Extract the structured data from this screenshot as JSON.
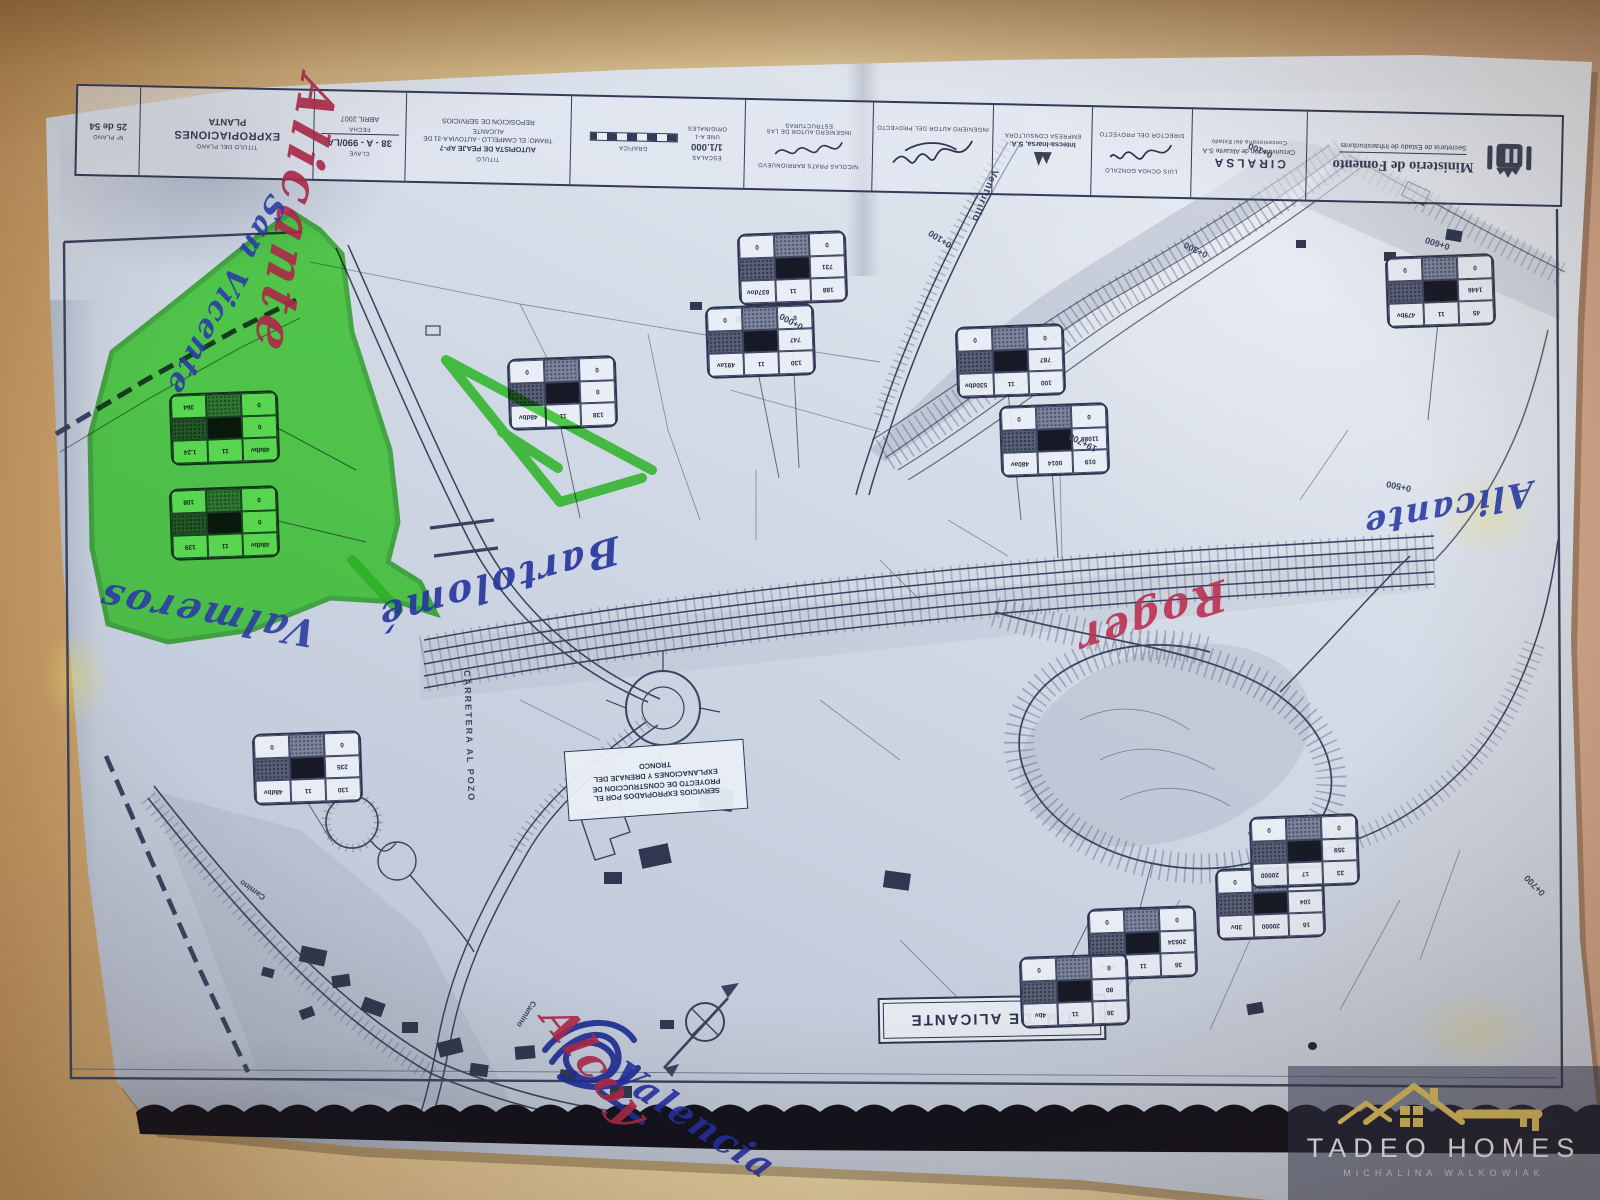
{
  "title_block": {
    "sheet_no": {
      "label": "Nº PLANO",
      "value": "25 de 54"
    },
    "plan_title": {
      "label": "TITULO DEL PLANO",
      "line1": "EXPROPIACIONES",
      "line2": "PLANTA"
    },
    "code": {
      "label": "CLAVE",
      "value": "38 - A - 990/LA",
      "date_label": "FECHA",
      "date": "ABRIL 2007"
    },
    "project": {
      "label": "TITULO",
      "line1": "AUTOPISTA DE PEAJE AP-7",
      "line2": "TRAMO: EL CAMPELLO - AUTOVIA A-31 DE ALICANTE",
      "line3": "REPOSICION DE SERVICIOS"
    },
    "scales": {
      "label": "ESCALAS",
      "value": "1/1.000",
      "note1": "UNE A-1",
      "note2": "ORIGINALES",
      "graphic_label": "GRAFICA"
    },
    "structures": {
      "name": "NICOLAS PRATS BARRIONUEVO",
      "role": "INGENIERO AUTOR DE LAS ESTRUCTURAS"
    },
    "author": {
      "role": "INGENIERO AUTOR DEL PROYECTO"
    },
    "consultant": {
      "name": "Intecsa-Inarsa, S.A.",
      "role": "EMPRESA CONSULTORA"
    },
    "director": {
      "name": "LUIS OCHOA GONZALO",
      "role": "DIRECTOR DEL PROYECTO"
    },
    "ciralsa": {
      "name": "CIRALSA",
      "line2": "Circunvalación de Alicante S.A",
      "line3": "Concesionaria del Estado"
    },
    "ministry": {
      "line1": "Ministerio de Fomento",
      "line2": "Secretaría de Estado de Infraestructuras"
    }
  },
  "map": {
    "tm_label": "T.M. DE ALICANTE",
    "services_box": [
      "SERVICIOS EXPROPIADOS POR EL",
      "PROYECTO DE CONSTRUCCION DE",
      "EXPLANACIONES Y DRENAJE DEL",
      "TRONCO"
    ],
    "labels": [
      {
        "t": "0+000",
        "x": 800,
        "y": 332,
        "r": 208,
        "s": 9
      },
      {
        "t": "0+100",
        "x": 948,
        "y": 250,
        "r": 212,
        "s": 9
      },
      {
        "t": "0+300",
        "x": 1205,
        "y": 260,
        "r": 206,
        "s": 9
      },
      {
        "t": "0+600",
        "x": 1448,
        "y": 252,
        "r": 197,
        "s": 9
      },
      {
        "t": "0+500",
        "x": 1410,
        "y": 494,
        "r": 192,
        "s": 9
      },
      {
        "t": "19+700",
        "x": 1094,
        "y": 454,
        "r": 207,
        "s": 9
      },
      {
        "t": "0+700",
        "x": 1540,
        "y": 898,
        "r": 225,
        "s": 9
      },
      {
        "t": "0+100",
        "x": 1270,
        "y": 160,
        "r": 203,
        "s": 9
      },
      {
        "t": "CARRETERA AL POZO",
        "x": 472,
        "y": 670,
        "r": 88,
        "s": 9,
        "ls": 2
      },
      {
        "t": "Venturillo",
        "x": 1000,
        "y": 172,
        "r": 112,
        "s": 10,
        "ls": 1
      },
      {
        "t": "Camino",
        "x": 538,
        "y": 1004,
        "r": 122,
        "s": 8
      },
      {
        "t": "Camino",
        "x": 262,
        "y": 902,
        "r": 215,
        "s": 8
      }
    ],
    "parcel_tables": [
      {
        "x": 170,
        "y": 392,
        "cells": [
          "364",
          "▓",
          "0",
          "▒",
          "█",
          "0",
          "1.24",
          "11",
          "48dbv"
        ]
      },
      {
        "x": 170,
        "y": 487,
        "cells": [
          "108",
          "▓",
          "0",
          "▒",
          "█",
          "0",
          "139",
          "11",
          "48dbv"
        ]
      },
      {
        "x": 508,
        "y": 357,
        "cells": [
          "0",
          "▓",
          "0",
          "▒",
          "█",
          "0",
          "48dbv",
          "11",
          "138"
        ]
      },
      {
        "x": 738,
        "y": 232,
        "cells": [
          "0",
          "▓",
          "0",
          "▒",
          "█",
          "731",
          "637dov",
          "11",
          "188"
        ]
      },
      {
        "x": 706,
        "y": 305,
        "cells": [
          "0",
          "▓",
          "0",
          "▒",
          "█",
          "747",
          "491av",
          "11",
          "130"
        ]
      },
      {
        "x": 956,
        "y": 325,
        "cells": [
          "0",
          "▓",
          "0",
          "▒",
          "█",
          "787",
          "530dbv",
          "11",
          "100"
        ]
      },
      {
        "x": 1000,
        "y": 404,
        "cells": [
          "0",
          "▓",
          "0",
          "▒",
          "█",
          "11088",
          "480av",
          "0014",
          "019"
        ]
      },
      {
        "x": 1386,
        "y": 255,
        "cells": [
          "0",
          "▓",
          "0",
          "▒",
          "█",
          "1446",
          "479bv",
          "11",
          "45"
        ]
      },
      {
        "x": 253,
        "y": 732,
        "cells": [
          "0",
          "▓",
          "0",
          "▒",
          "█",
          "235",
          "48dbv",
          "11",
          "130"
        ]
      },
      {
        "x": 1088,
        "y": 907,
        "cells": [
          "0",
          "▓",
          "0",
          "▒",
          "█",
          "20634",
          "480av",
          "11",
          "36"
        ]
      },
      {
        "x": 1020,
        "y": 955,
        "cells": [
          "0",
          "▓",
          "0",
          "▒",
          "█",
          "80",
          "4bv",
          "11",
          "36"
        ]
      },
      {
        "x": 1216,
        "y": 867,
        "cells": [
          "0",
          "▓",
          "0",
          "▒",
          "█",
          "104",
          "3bv",
          "20000",
          "16"
        ]
      },
      {
        "x": 1250,
        "y": 815,
        "cells": [
          "0",
          "▓",
          "0",
          "▒",
          "█",
          "359",
          "20000",
          "17",
          "33"
        ]
      }
    ]
  },
  "annotations": {
    "highlighter_color": "#3fe32c",
    "pen_blue": "#2b3da5",
    "pen_red": "#ad2848",
    "handwriting": [
      {
        "t": "Alicante",
        "c": "#ad2848",
        "x": 348,
        "y": 88,
        "r": 100,
        "s": 52,
        "ls": 5
      },
      {
        "t": "San Vicente",
        "c": "#2b3da5",
        "x": 292,
        "y": 208,
        "r": 118,
        "s": 30,
        "ls": 2
      },
      {
        "t": "Valmeros",
        "c": "#2b3da5",
        "x": 308,
        "y": 656,
        "r": 190,
        "s": 38,
        "ls": 3
      },
      {
        "t": "Bartolomé",
        "c": "#25359e",
        "x": 622,
        "y": 572,
        "r": 164,
        "s": 38,
        "ls": 3
      },
      {
        "t": "Roger",
        "c": "#bb3152",
        "x": 1230,
        "y": 618,
        "r": 162,
        "s": 42,
        "ls": 3
      },
      {
        "t": "Alicante",
        "c": "#2b3da5",
        "x": 1534,
        "y": 512,
        "r": 169,
        "s": 34,
        "ls": 2
      },
      {
        "t": "Alcoy",
        "c": "#ad2848",
        "x": 574,
        "y": 998,
        "r": 52,
        "s": 44,
        "ls": 2
      },
      {
        "t": "Valencia",
        "c": "#222fa4",
        "x": 630,
        "y": 1054,
        "r": 33,
        "s": 36,
        "ls": 2
      }
    ]
  },
  "watermark": {
    "brand": "TADEO HOMES",
    "subtitle": "MICHALINA WALKOWIAK"
  }
}
